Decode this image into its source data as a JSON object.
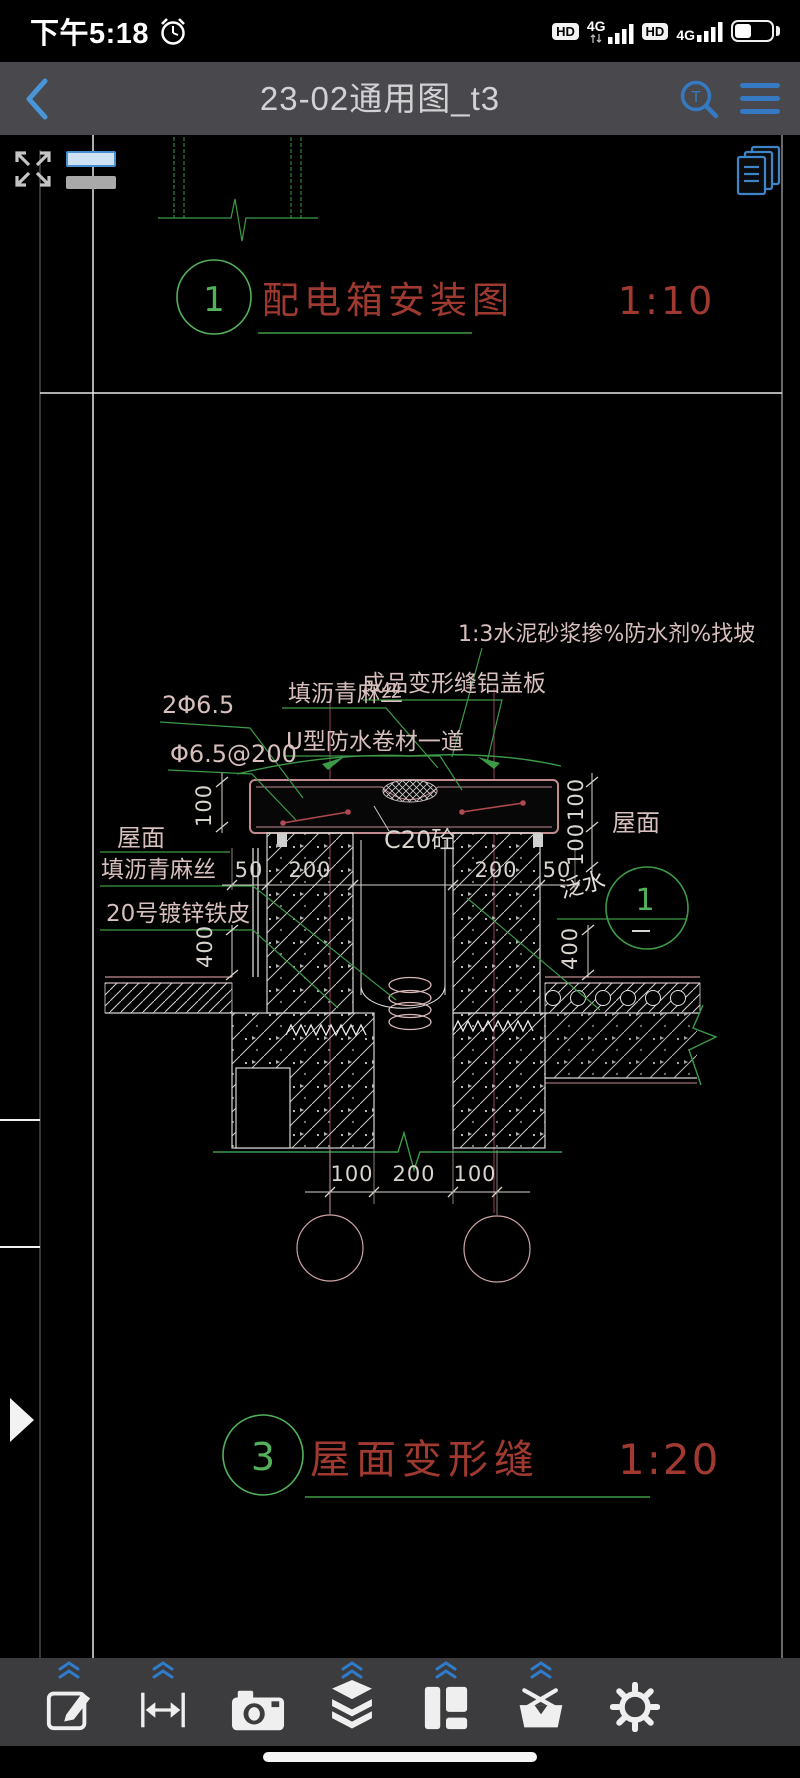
{
  "colors": {
    "accent_blue": "#3e86c7",
    "cad_green": "#3c9a47",
    "cad_red": "#a03a31",
    "cad_pink": "#c18b90",
    "annotation_pink": "#d6bfbd",
    "dim_white": "#d8d3cd",
    "axis_maroon": "#6b3040",
    "nav_bg": "#49494d",
    "toolbar_bg": "#3c3c3f"
  },
  "status_bar": {
    "time": "下午5:18",
    "net1_badge": "HD",
    "net1_type": "4G",
    "net2_badge": "HD",
    "net2_type": "4G",
    "battery_percent": 45
  },
  "nav_bar": {
    "title": "23-02通用图_t3",
    "search_glyph": "T"
  },
  "viewer_toolbar": {
    "icons": [
      "fullscreen",
      "line-style",
      "sheet-manager"
    ]
  },
  "details": {
    "d1": {
      "number": "1",
      "title": "配电箱安装图",
      "scale": "1:10"
    },
    "d3": {
      "number": "3",
      "title": "屋面变形缝",
      "scale": "1:20"
    }
  },
  "annotations": {
    "mortar": "1:3水泥砂浆掺%防水剂%找坡",
    "cover_plate": "成品变形缝铝盖板",
    "asphalt_top": "填沥青麻丝",
    "membrane": "U型防水卷材一道",
    "rebar_a": "2Φ6.5",
    "rebar_b": "Φ6.5@200",
    "roof_left": "屋面",
    "asphalt_left": "填沥青麻丝",
    "steel_sheet": "20号镀锌铁皮",
    "concrete": "C20砼",
    "roof_right": "屋面",
    "flashing": "泛水",
    "bubble_number": "1"
  },
  "dims": {
    "d50": "50",
    "d100": "100",
    "d200": "200",
    "d400": "400"
  },
  "bottom_toolbar": {
    "icons": [
      "edit",
      "measure",
      "camera",
      "layers",
      "layout",
      "toolbox",
      "settings"
    ]
  }
}
